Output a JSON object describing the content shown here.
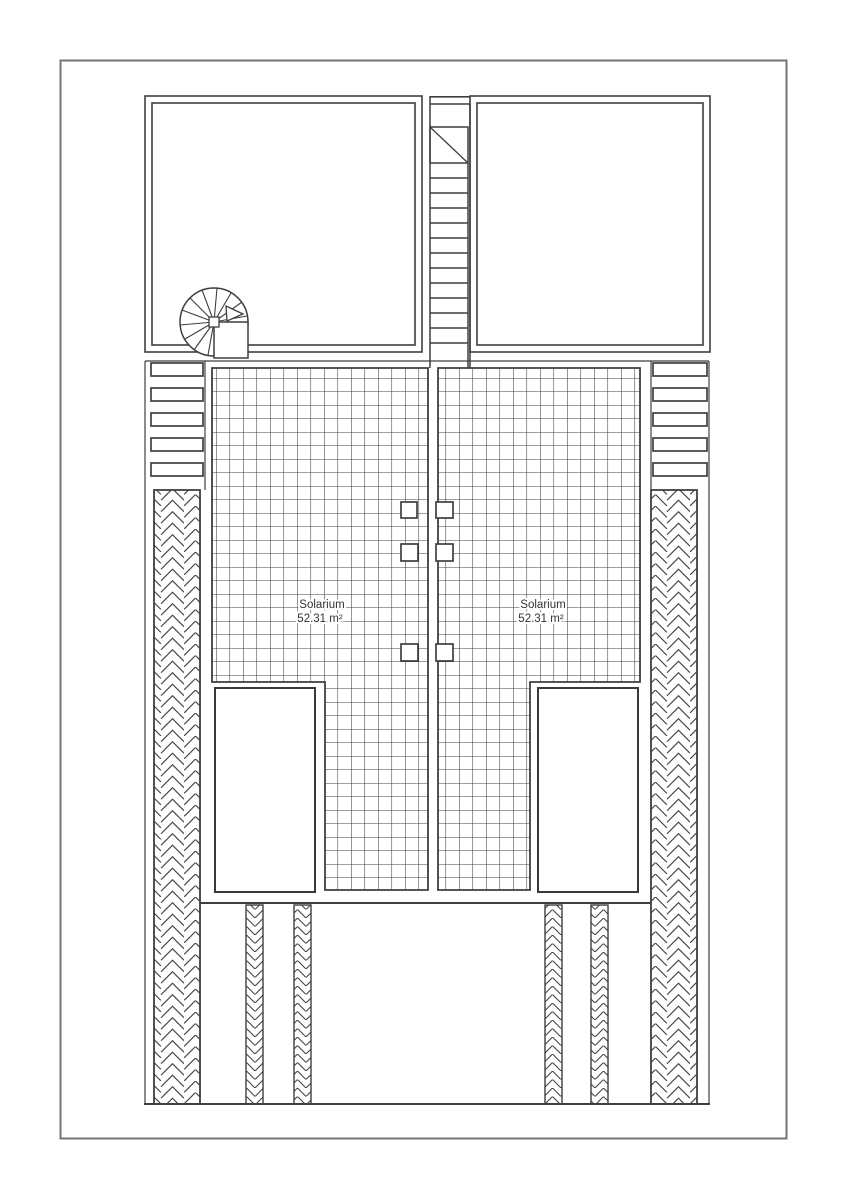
{
  "page": {
    "background": "#ffffff",
    "ink_color": "#3f3f3f",
    "border_color": "#757575",
    "document_type": "architectural roof plan"
  },
  "plan": {
    "labels": {
      "left_solarium": {
        "name": "Solarium",
        "area": "52.31 m²"
      },
      "right_solarium": {
        "name": "Solarium",
        "area": "52.31 m²"
      }
    }
  }
}
